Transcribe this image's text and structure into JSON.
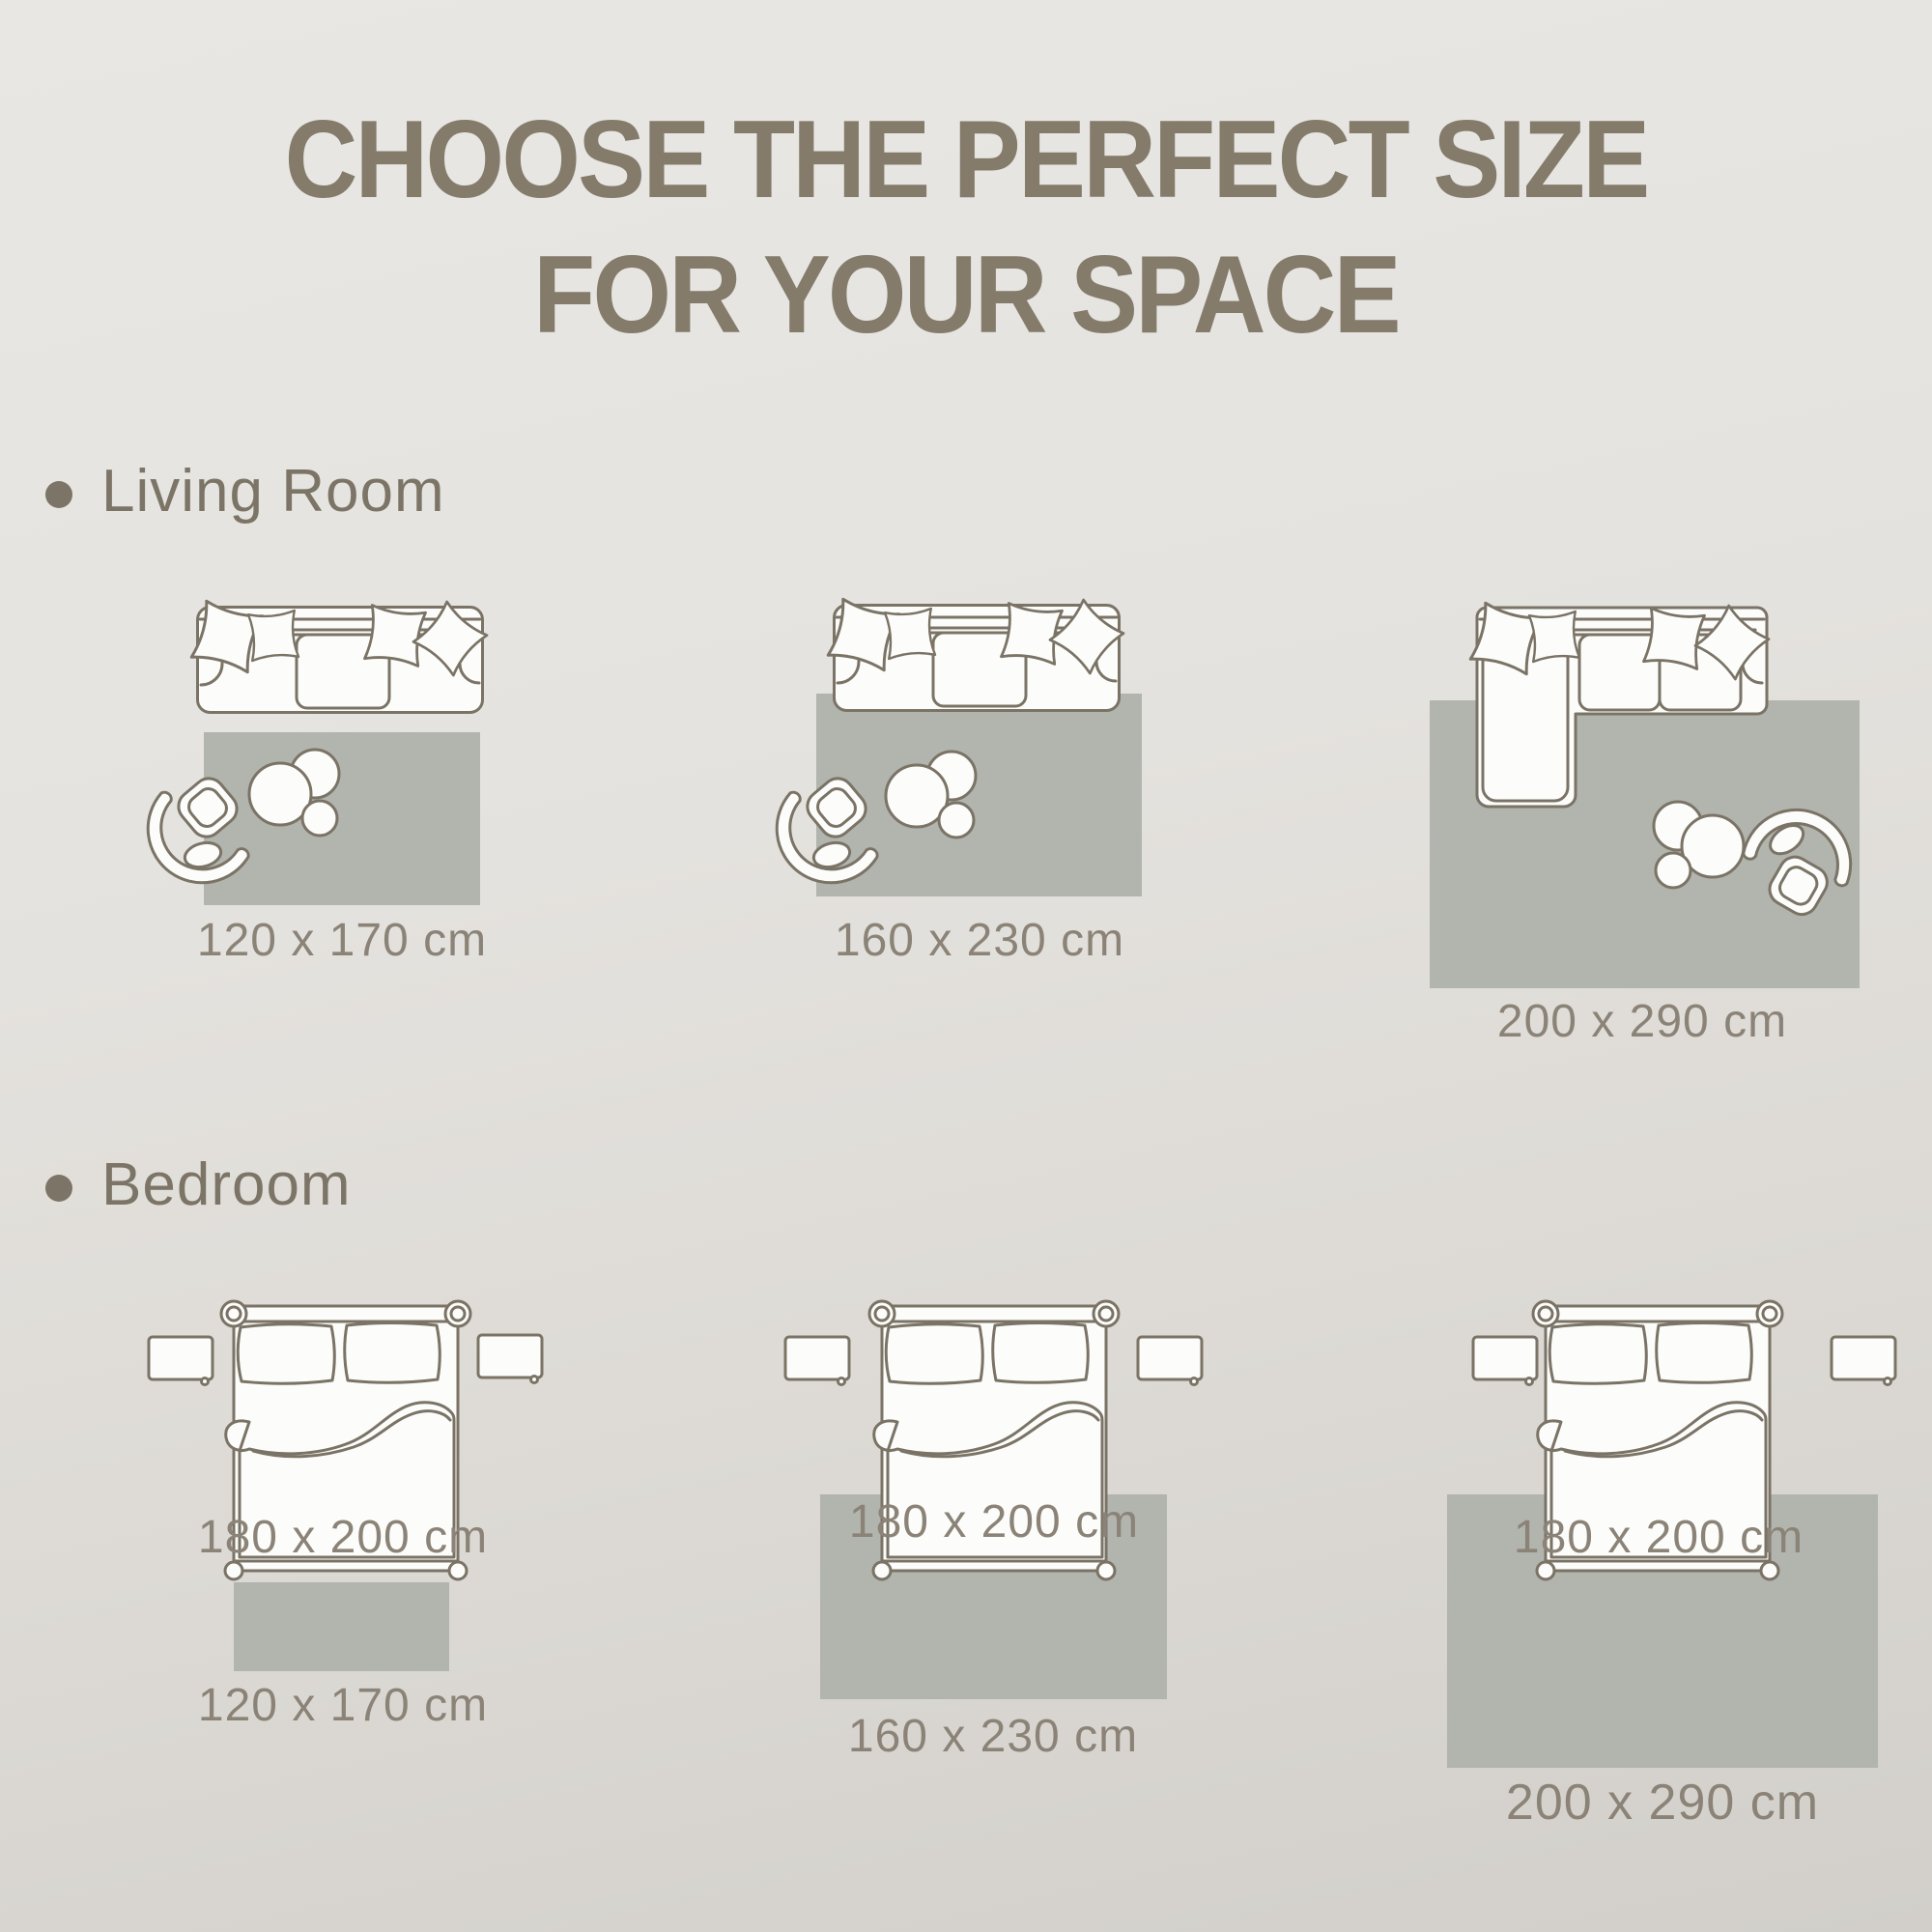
{
  "title": {
    "line1": "CHOOSE THE PERFECT SIZE",
    "line2": "FOR YOUR SPACE"
  },
  "sections": {
    "living_room": {
      "label": "Living Room",
      "rugs": [
        {
          "size": "120 x 170 cm"
        },
        {
          "size": "160 x 230 cm"
        },
        {
          "size": "200 x 290 cm"
        }
      ]
    },
    "bedroom": {
      "label": "Bedroom",
      "bed_size": "180 x 200 cm",
      "rugs": [
        {
          "size": "120 x 170 cm"
        },
        {
          "size": "160 x 230 cm"
        },
        {
          "size": "200 x 290 cm"
        }
      ]
    }
  },
  "icons": {
    "bullet_icon": "filled-circle",
    "sofa_icon": "three-seat-sofa-top-view",
    "sectional_sofa_icon": "l-shaped-sofa-top-view",
    "armchair_icon": "round-swivel-chair-top-view",
    "coffee_table_icon": "nesting-round-tables-top-view",
    "bed_icon": "double-bed-top-view",
    "nightstand_icon": "bedside-table-top-view",
    "rug_icon": "gray-rectangle-rug"
  },
  "colors": {
    "background_top": "#e9e7e3",
    "background_bottom": "#d2cfca",
    "title_text": "#847b6b",
    "section_text": "#7c7567",
    "label_text": "#8b8377",
    "outline_stroke": "#7a7366",
    "furniture_fill": "#fcfcfa",
    "rug_fill": "#b2b4ae"
  }
}
